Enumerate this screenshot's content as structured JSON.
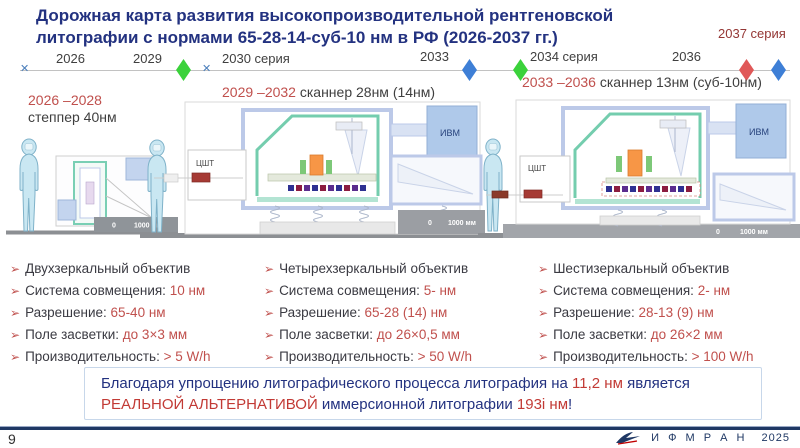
{
  "title": {
    "line1": "Дорожная карта развития высокопроизводительной рентгеновской",
    "line2": "литографии с нормами 65-28-14-суб-10 нм в РФ  (2026-2037 гг.)"
  },
  "timeline": {
    "y2026": "2026",
    "y2029": "2029",
    "s2030": "2030 серия",
    "y2033": "2033",
    "s2034": "2034 серия",
    "y2036": "2036",
    "s2037": "2037 серия"
  },
  "stages": [
    {
      "period": "2026 –2028",
      "name": "степпер 40нм"
    },
    {
      "period": "2029 –2032",
      "name": " сканнер 28нм (14нм)"
    },
    {
      "period": "2033 –2036",
      "name": " сканнер 13нм (суб-10нм)"
    }
  ],
  "machine_labels": {
    "ivm": "ИВМ",
    "tsht": "ЦШТ",
    "scale_zero": "0",
    "scale": "1000 мм"
  },
  "specs": {
    "marker": "➢",
    "columns": [
      {
        "items": [
          {
            "label": "Двухзеркальный объектив",
            "value": ""
          },
          {
            "label": "Система совмещения:",
            "value": "10 нм"
          },
          {
            "label": "Разрешение:",
            "value": "65-40 нм"
          },
          {
            "label": "Поле засветки:",
            "value": "до 3×3 мм"
          },
          {
            "label": "Производительность:",
            "value": "> 5 W/h"
          }
        ]
      },
      {
        "items": [
          {
            "label": "Четырехзеркальный объектив",
            "value": ""
          },
          {
            "label": "Система совмещения:",
            "value": "5- нм"
          },
          {
            "label": "Разрешение:",
            "value": "65-28 (14) нм"
          },
          {
            "label": "Поле засветки:",
            "value": "до 26×0,5 мм"
          },
          {
            "label": "Производительность:",
            "value": "> 50 W/h"
          }
        ]
      },
      {
        "items": [
          {
            "label": "Шестизеркальный объектив",
            "value": ""
          },
          {
            "label": "Система совмещения:",
            "value": "2- нм"
          },
          {
            "label": "Разрешение:",
            "value": "28-13 (9) нм"
          },
          {
            "label": "Поле засветки:",
            "value": "до 26×2 мм"
          },
          {
            "label": "Производительность:",
            "value": "> 100 W/h"
          }
        ]
      }
    ]
  },
  "banner": {
    "line1_a": "Благодаря упрощению литографического процесса литография на ",
    "line1_b": "11,2 нм",
    "line1_c": " является",
    "line2_a": "РЕАЛЬНОЙ АЛЬТЕРНАТИВОЙ",
    "line2_b": " иммерсионной литографии ",
    "line2_c": "193i нм",
    "line2_d": "!"
  },
  "footer": {
    "page": "9",
    "org": "И Ф М  Р А Н",
    "year": "2025"
  },
  "colors": {
    "title_navy": "#233280",
    "accent_red": "#C0504D",
    "dark_red": "#943634",
    "green_diamond": "#3BD23B",
    "blue_diamond": "#3E7FD6",
    "red_diamond": "#E05858",
    "marker_blue": "#4A7EBB"
  }
}
